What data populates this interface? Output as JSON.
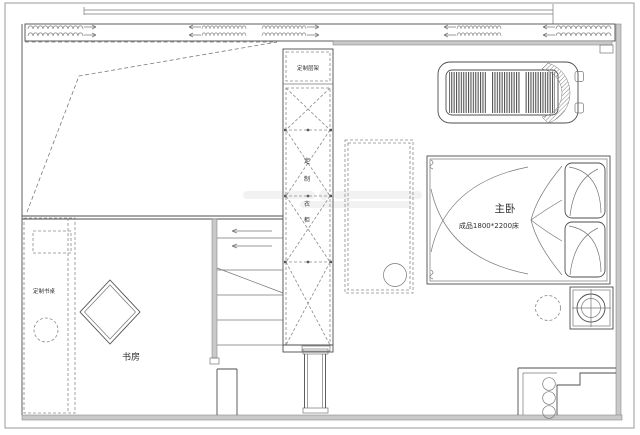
{
  "plan": {
    "labels": {
      "master_bedroom": "主卧",
      "bed_spec": "成品1800*2200床",
      "study": "书房",
      "custom_desk": "定制书桌",
      "custom_shelf": "定制层架",
      "wardrobe_chars": [
        "定",
        "制",
        "衣",
        "柜"
      ]
    },
    "colors": {
      "line": "#4d4d4d",
      "dashed_line": "#7a7a7a",
      "wall_fill": "#c9c9c9",
      "background": "#ffffff"
    }
  }
}
